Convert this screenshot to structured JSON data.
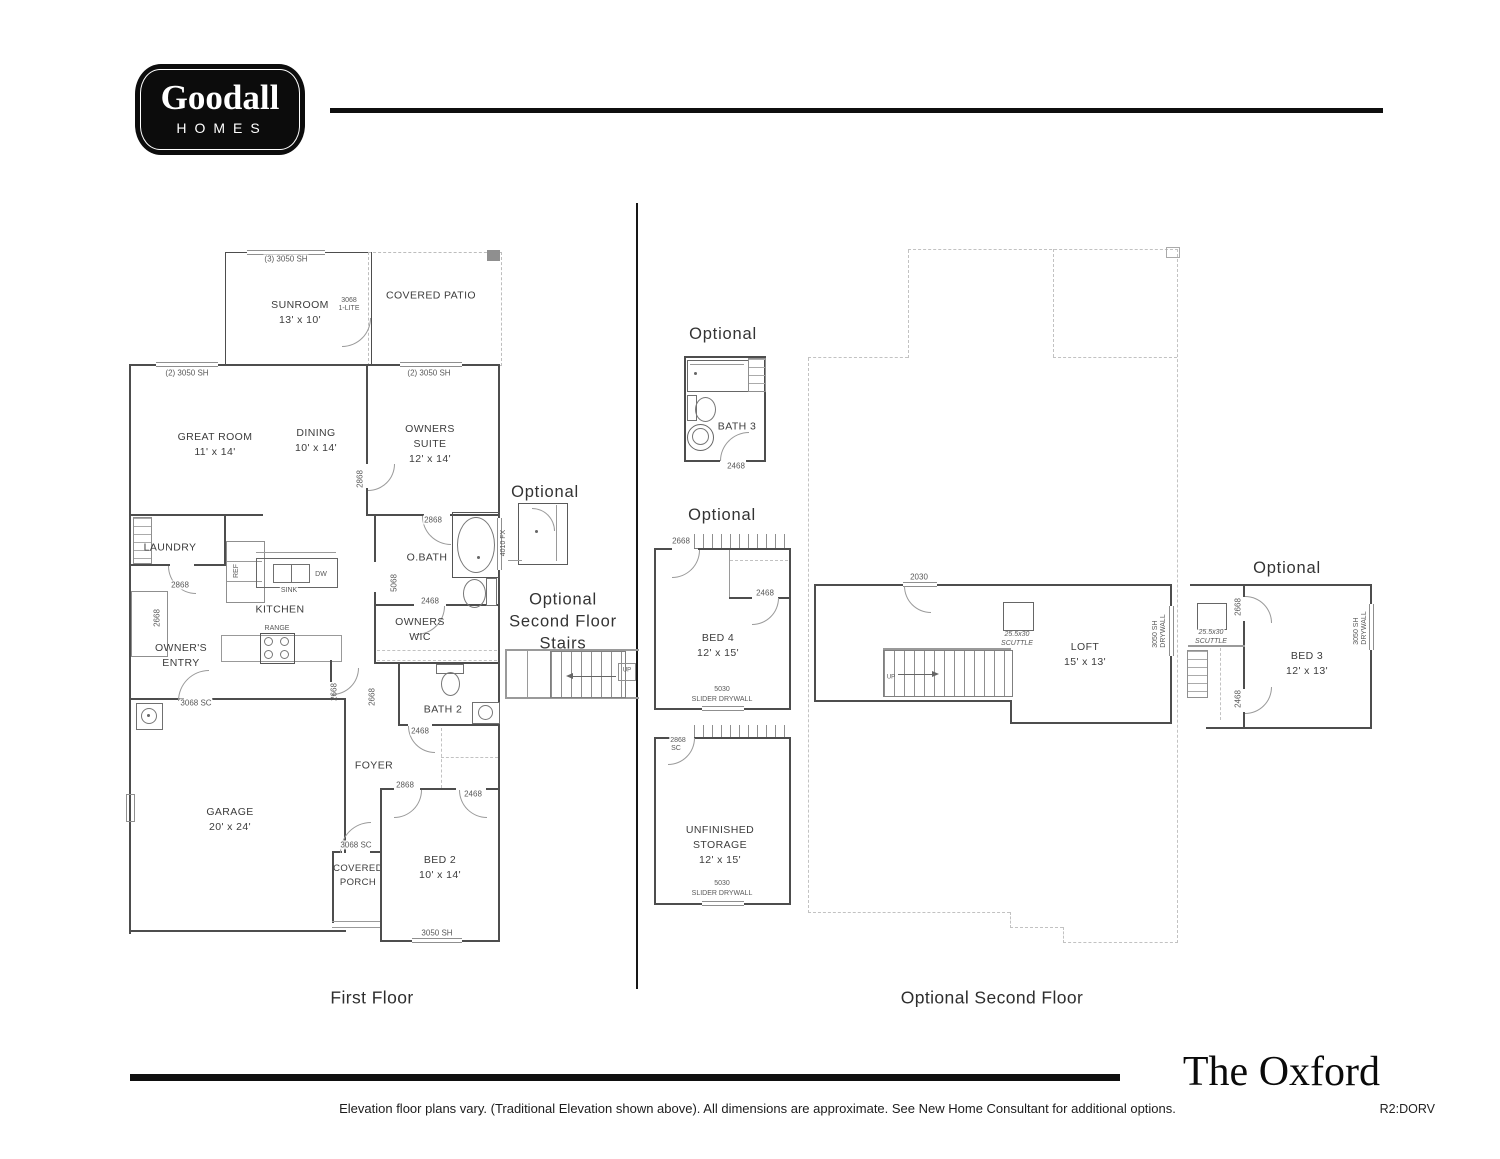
{
  "logo": {
    "brand": "Goodall",
    "word": "HOMES"
  },
  "plan_titles": {
    "first": "First Floor",
    "second": "Optional Second Floor"
  },
  "footer": {
    "plan_name": "The Oxford",
    "disclaimer": "Elevation floor plans vary. (Traditional Elevation shown above). All dimensions are approximate. See New Home Consultant for additional options.",
    "revision": "R2:DORV"
  },
  "optional": {
    "shower": "Optional",
    "stairs_line1": "Optional",
    "stairs_line2": "Second Floor",
    "stairs_line3": "Stairs",
    "bath3": "Optional",
    "bed4": "Optional",
    "bed3": "Optional"
  },
  "first_floor": {
    "rooms": {
      "sunroom": {
        "name": "SUNROOM",
        "dims": "13' x 10'"
      },
      "covered_patio": {
        "name": "COVERED PATIO"
      },
      "great_room": {
        "name": "GREAT ROOM",
        "dims": "11' x 14'"
      },
      "dining": {
        "name": "DINING",
        "dims": "10' x 14'"
      },
      "owners_suite": {
        "name": "OWNERS",
        "name2": "SUITE",
        "dims": "12' x 14'"
      },
      "laundry": {
        "name": "LAUNDRY"
      },
      "kitchen": {
        "name": "KITCHEN"
      },
      "obath": {
        "name": "O.BATH"
      },
      "owners_wic": {
        "name": "OWNERS",
        "name2": "WIC"
      },
      "owners_entry": {
        "name": "OWNER'S",
        "name2": "ENTRY"
      },
      "bath2": {
        "name": "BATH 2"
      },
      "foyer": {
        "name": "FOYER"
      },
      "garage": {
        "name": "GARAGE",
        "dims": "20' x 24'"
      },
      "covered_porch": {
        "name": "COVERED",
        "name2": "PORCH"
      },
      "bed2": {
        "name": "BED 2",
        "dims": "10' x 14'"
      }
    },
    "fixtures": {
      "sink": "SINK",
      "dw": "DW",
      "range": "RANGE",
      "ref": "REF"
    },
    "ann": {
      "sunroom_window": "(3) 3050 SH",
      "sunroom_door_size": "3068",
      "sunroom_door_type": "1-LITE",
      "great_window": "(2) 3050 SH",
      "owners_window": "(2) 3050 SH",
      "dining_owners_door": "2868",
      "laundry_door": "2868",
      "obath_door": "2868",
      "obath_window": "4010 FX",
      "obath_opening": "5068",
      "wic_door": "2468",
      "entry_door": "2668",
      "entry_garage_door": "3068 SC",
      "hall_door": "2668",
      "foyer_door": "2668",
      "bath2_door": "2468",
      "bed2_door": "2868",
      "bed2_closet_door": "2468",
      "porch_door": "3068 SC",
      "bed2_window": "3050 SH",
      "stairs_up": "UP"
    }
  },
  "second_floor": {
    "rooms": {
      "bath3": {
        "name": "BATH 3"
      },
      "bed4": {
        "name": "BED 4",
        "dims": "12' x 15'"
      },
      "storage": {
        "name": "UNFINISHED",
        "name2": "STORAGE",
        "dims": "12' x 15'"
      },
      "loft": {
        "name": "LOFT",
        "dims": "15' x 13'"
      },
      "bed3": {
        "name": "BED 3",
        "dims": "12' x 13'"
      }
    },
    "ann": {
      "bath3_door": "2468",
      "bed4_door": "2668",
      "bed4_closet_door": "2468",
      "slider_size": "5030",
      "slider_label": "SLIDER DRYWALL",
      "storage_door_size": "2868",
      "storage_door_type": "SC",
      "loft_window": "2030",
      "scuttle_size": "25.5x30",
      "scuttle_label": "SCUTTLE",
      "drywall_line1": "3050 SH",
      "drywall_line2": "DRYWALL",
      "bed3_door": "2668",
      "bed3_closet_door": "2468",
      "stairs_up": "UP"
    }
  }
}
